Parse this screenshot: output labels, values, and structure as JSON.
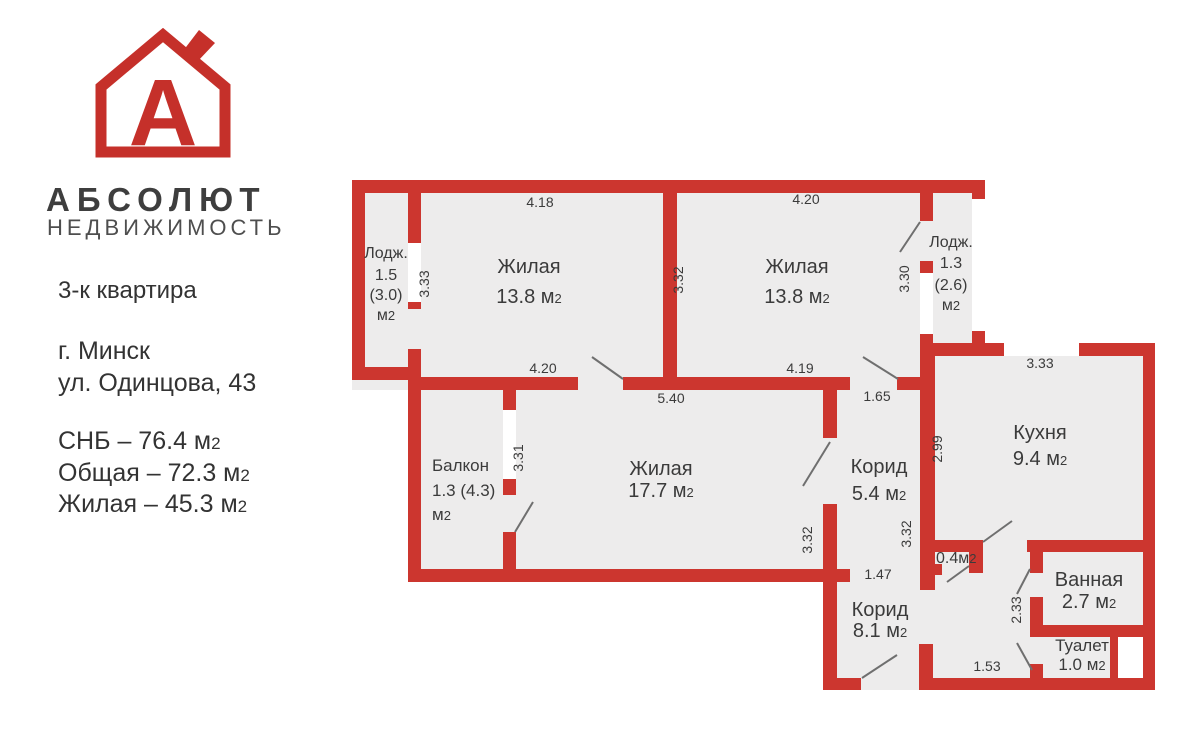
{
  "colors": {
    "wall": "#cc362f",
    "floor": "#edecec",
    "logo": "#c5302a",
    "ink": "#3b3b3b",
    "door_line": "#6f6f6f"
  },
  "sub2": "2",
  "brand": {
    "name": "АБСОЛЮТ",
    "subtitle": "НЕДВИЖИМОСТЬ",
    "logo_letter": "А"
  },
  "listing": {
    "title": "3-к квартира",
    "city": "г. Минск",
    "address": "ул. Одинцова, 43",
    "areas": [
      {
        "label": "СНБ – 76.4 м"
      },
      {
        "label": "Общая –  72.3 м"
      },
      {
        "label": "Жилая – 45.3 м"
      }
    ]
  },
  "plan": {
    "rooms": {
      "loggia_left": {
        "l1": "Лодж.",
        "l2": "1.5",
        "l3": "(3.0)",
        "unit": "м"
      },
      "room1": {
        "name": "Жилая",
        "area": "13.8 м"
      },
      "room2": {
        "name": "Жилая",
        "area": "13.8 м"
      },
      "loggia_right": {
        "l1": "Лодж.",
        "l2": "1.3",
        "l3": "(2.6)",
        "unit": "м"
      },
      "balcony": {
        "l1": "Балкон",
        "l2": "1.3 (4.3)",
        "unit": "м"
      },
      "room3": {
        "name": "Жилая",
        "area": "17.7 м"
      },
      "corridor1": {
        "name": "Корид",
        "area": "5.4 м"
      },
      "kitchen": {
        "name": "Кухня",
        "area": "9.4 м"
      },
      "closet": {
        "area": "0.4м"
      },
      "bathroom": {
        "name": "Ванная",
        "area": "2.7 м"
      },
      "corridor2": {
        "name": "Корид",
        "area": "8.1 м"
      },
      "toilet": {
        "name": "Туалет",
        "area": "1.0 м"
      }
    },
    "dims": {
      "room1_top": "4.18",
      "room2_top": "4.20",
      "kitchen_top": "3.33",
      "room1_bottom": "4.20",
      "room2_bottom": "4.19",
      "room3_top": "5.40",
      "corridor1_top": "1.65",
      "corridor1_bottom": "1.47",
      "hall_bottom": "1.53",
      "loggia_left_h": "3.33",
      "rooms_mid_h": "3.32",
      "room2_right_h": "3.30",
      "kitchen_left_h": "2.99",
      "balcony_h": "3.31",
      "room3_right_h": "3.32",
      "corridor1_right_h": "3.32",
      "bathroom_h": "2.33"
    }
  }
}
